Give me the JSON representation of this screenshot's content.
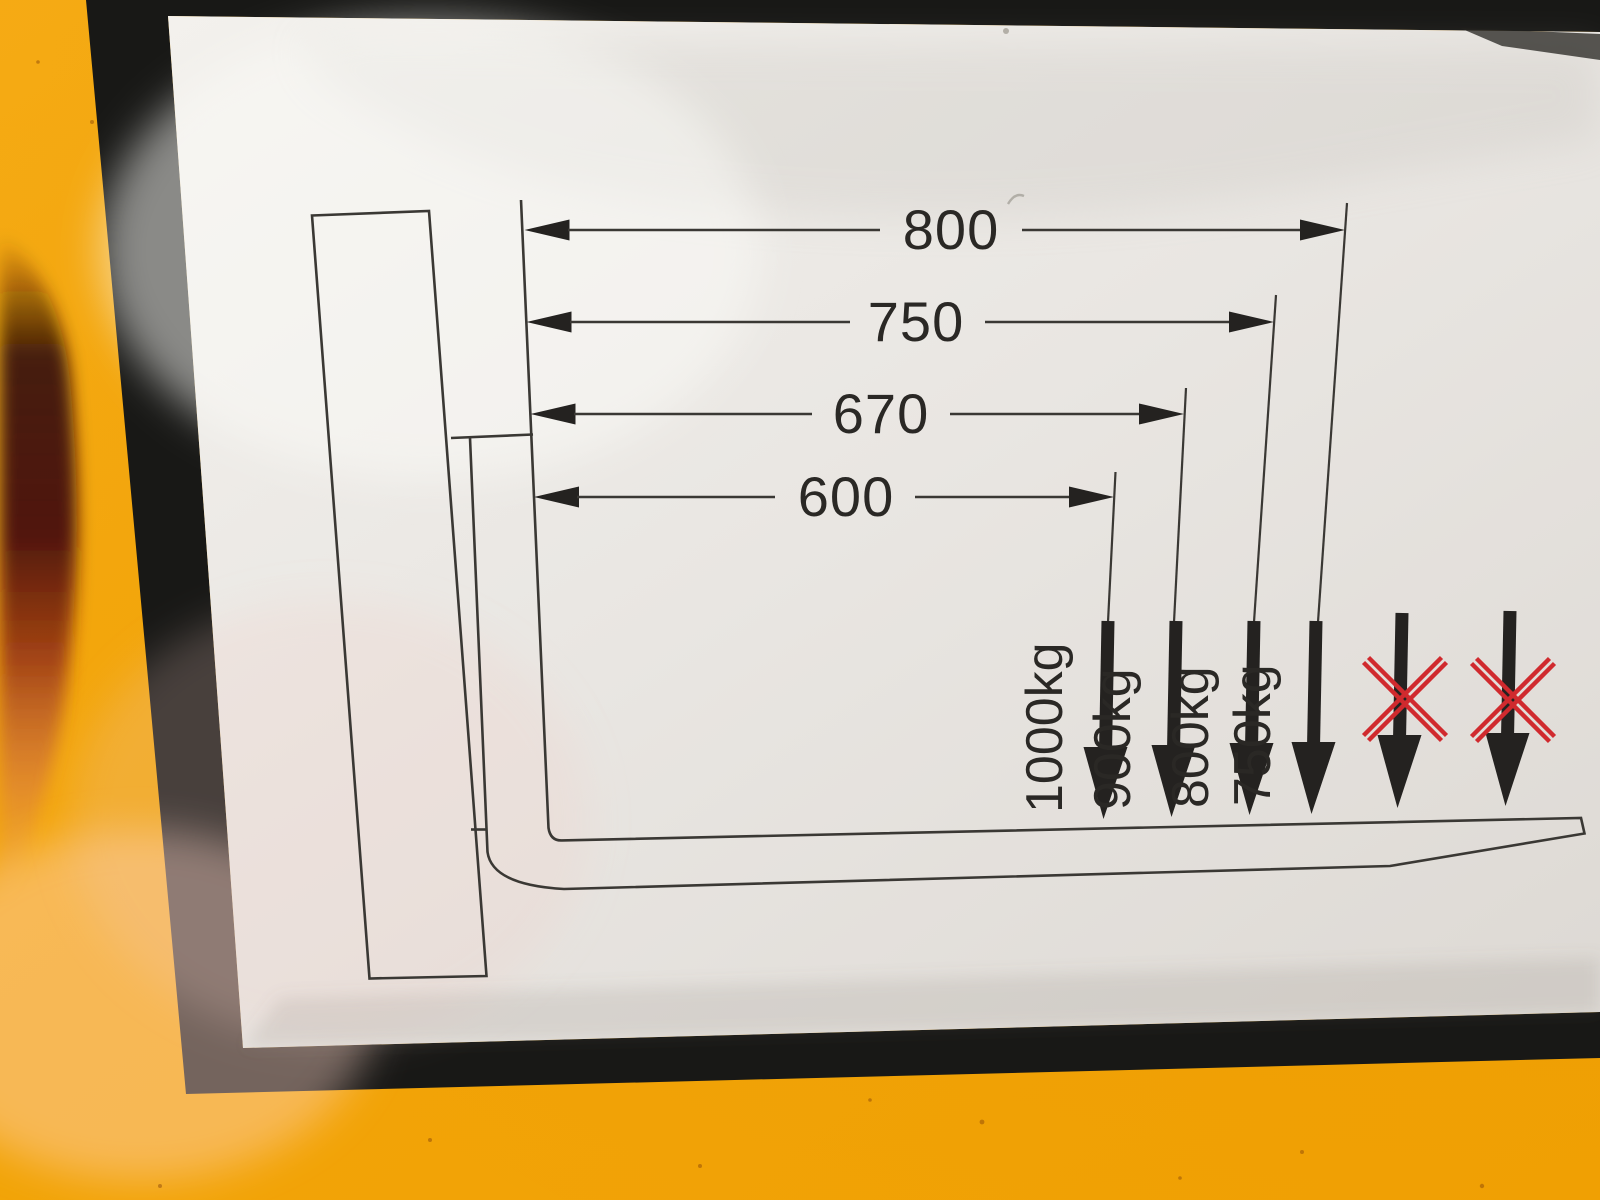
{
  "scene": {
    "subject": "Forklift fork load capacity label on yellow machine panel"
  },
  "colors": {
    "machine_yellow": "#f3a50c",
    "label_border_black": "#181816",
    "label_face": "#eae7e3",
    "diagram_line": "#3a3834",
    "arrow_black": "#242220",
    "text_dark": "#2a2825",
    "prohibited_red": "#d02a2e"
  },
  "diagram": {
    "load_center_dimensions_mm": [
      {
        "label": "800"
      },
      {
        "label": "750"
      },
      {
        "label": "670"
      },
      {
        "label": "600"
      }
    ],
    "load_capacities": [
      {
        "label": "1000kg"
      },
      {
        "label": "900kg"
      },
      {
        "label": "800kg"
      },
      {
        "label": "750kg"
      }
    ],
    "capacity_by_load_center": [
      {
        "load_center_mm": 600,
        "capacity_kg": 1000
      },
      {
        "load_center_mm": 670,
        "capacity_kg": 900
      },
      {
        "load_center_mm": 750,
        "capacity_kg": 800
      },
      {
        "load_center_mm": 800,
        "capacity_kg": 750
      }
    ],
    "prohibited_positions": 2
  }
}
